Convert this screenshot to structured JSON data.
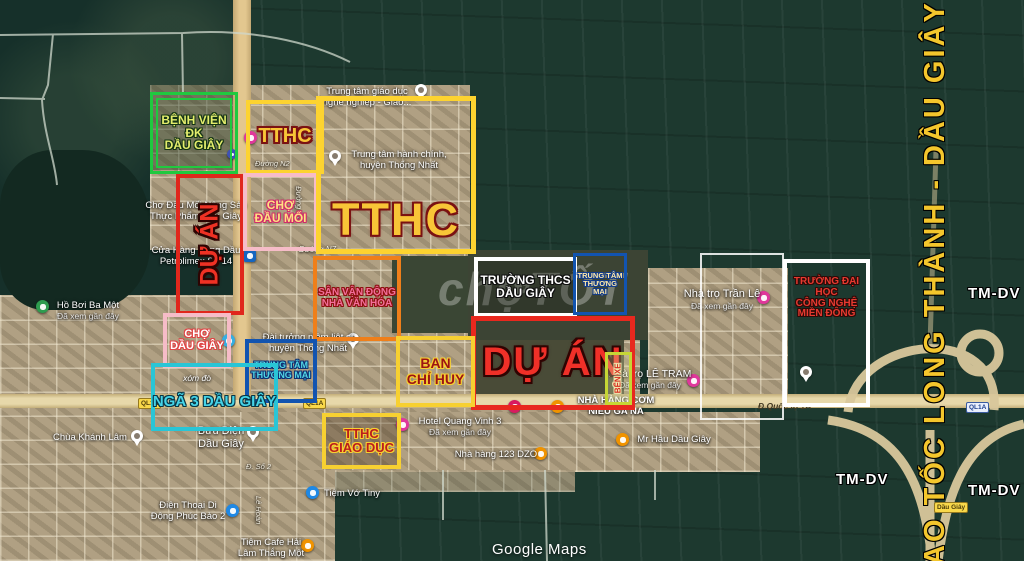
{
  "map": {
    "provider_watermark": "Google Maps",
    "photo_watermark": "chợTỐT",
    "highway_label": "CAO TỐC LONG THÀNH - DẦU GIÂY",
    "zone_label": "TM-DV"
  },
  "boxes": {
    "hospital": {
      "label": "BỆNH VIỆN\nĐK\nDẦU GIÂY",
      "border_color": "#1fc93f"
    },
    "du_an_left": {
      "label": "DỰ ÁN",
      "border_color": "#e0271c"
    },
    "tthc_small": {
      "label": "TTHC",
      "border_color": "#fdd330"
    },
    "cho_dau_moi": {
      "label": "CHỢ\nĐẦU MỐI",
      "border_color": "#f6bcc8"
    },
    "tthc_big": {
      "label": "TTHC",
      "border_color": "#fdd330"
    },
    "san_van_dong": {
      "label": "SÂN VẬN ĐỘNG\nNHÀ VĂN HÓA",
      "border_color": "#ef7f1a"
    },
    "truong_thcs": {
      "label": "TRƯỜNG THCS\nDẦU GIÂY",
      "border_color": "#ffffff"
    },
    "tttm_top": {
      "label": "TRUNG TÂM\nTHƯƠNG MẠI",
      "border_color": "#1254b0"
    },
    "du_an_big": {
      "label": "DỰ ÁN",
      "border_color": "#e8281e"
    },
    "ban_chi_huy": {
      "label": "BAN\nCHỈ HUY",
      "border_color": "#f7d031"
    },
    "cho_dau_giay": {
      "label": "CHỢ\nDẦU GIÂY",
      "border_color": "#f6bcc8"
    },
    "tttm_bottom": {
      "label": "TRUNG TÂM\nTHƯƠNG MẠI",
      "border_color": "#1254b0"
    },
    "nga_3": {
      "label": "NGÃ 3 DẦU GIÂY",
      "border_color": "#29c5d6"
    },
    "tthc_giao_duc": {
      "label": "TTHC\nGIÁO DỤC",
      "border_color": "#f7d031"
    },
    "ben_xe": {
      "label": "BẾN XE",
      "border_color": "#c6d635"
    },
    "dai_hoc": {
      "label": "TRƯỜNG ĐẠI HỌC\nCÔNG NGHỆ\nMIỀN ĐÔNG",
      "border_color": "#ffffff"
    }
  },
  "streets": {
    "duong_n7": "Đường N7",
    "duong_n2": "Đường N2",
    "duong_n3": "Đường N3",
    "d_so_2": "Đ. Số 2",
    "le_hoan": "Lê Hoàn",
    "ql1a": "QL1A",
    "quoc_lo_1a": "Đ.Quốc lộ 1A",
    "dau_giay_exit": "Dầu Giây"
  },
  "pois": {
    "giao_duc": {
      "label": "Trung tâm giáo dục\nnghề nghiệp - Giáo..."
    },
    "hanh_chinh": {
      "label": "Trung tâm hành chính,\nhuyện Thống Nhất"
    },
    "cho_dau_moi_nong_san": {
      "label": "Chợ Đầu Mối Nông Sản\nThực Phẩm Dầu Giây"
    },
    "petrolimex": {
      "label": "Cửa Hàng Xăng Dầu\nPetrolimex Số 14"
    },
    "ho_boi": {
      "label": "Hồ Bơi Ba Một",
      "sub": "Đã xem gần đây"
    },
    "chua_khanh_lam": {
      "label": "Chùa Khánh Lâm"
    },
    "buu_dien": {
      "label": "Bưu Điện\nDầu Giây"
    },
    "dien_thoai": {
      "label": "Điện Thoại Di\nĐộng Phúc Bảo 2"
    },
    "cafe_hai": {
      "label": "Tiệm Cafe Hải\nLâm Thắng Một"
    },
    "tiem_vo_tiny": {
      "label": "Tiệm Vớ Tiny"
    },
    "nha_hang_123": {
      "label": "Nhà hàng 123 DZO"
    },
    "hotel_quang_vinh": {
      "label": "Hotel Quang Vinh 3",
      "sub": "Đã xem gần đây"
    },
    "com_nieu": {
      "label": "NHÀ HÀNG CƠM\nNIÊU GA NA"
    },
    "mr_hau": {
      "label": "Mr Hầu Dầu Giây"
    },
    "nha_tro_tran_le": {
      "label": "Nhà trọ Trần Lê",
      "sub": "Đã xem gần đây"
    },
    "nha_tro_le_tram": {
      "label": "Nhà trọ LÊ TRAM",
      "sub": "Đã xem gần đây"
    },
    "liet_si": {
      "label": "Đài tưởng niệm liệt sĩ\nhuyện Thống Nhất"
    },
    "xom_do": {
      "label": "xóm đò"
    }
  },
  "colors": {
    "annotation_yellow": "#fdd330",
    "annotation_red": "#e8281e",
    "annotation_green": "#1fc93f",
    "annotation_pink": "#f6bcc8",
    "annotation_orange": "#ef7f1a",
    "annotation_blue": "#1254b0",
    "annotation_cyan": "#29c5d6",
    "highway_text_yellow": "#f4c62c",
    "road_fill": "#e7d8aa",
    "satellite_dark_green": "#1d392f"
  }
}
